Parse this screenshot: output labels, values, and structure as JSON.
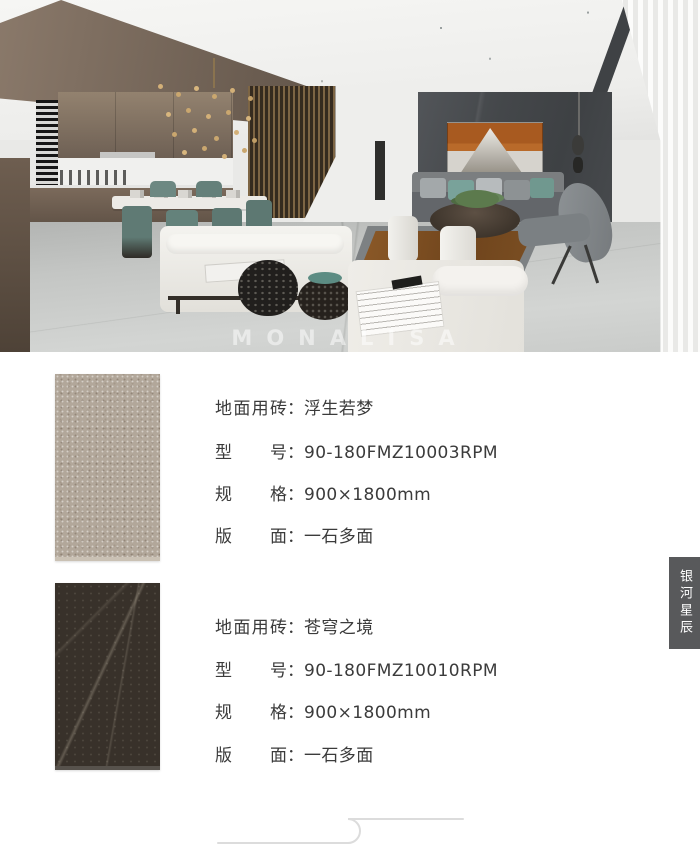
{
  "photo": {
    "watermark": "MONALISA"
  },
  "products": [
    {
      "swatch": "beige-stone-floor-tile",
      "rows": [
        {
          "label": "地面用砖",
          "colon": "：",
          "value": "浮生若梦"
        },
        {
          "label": "型号",
          "colon": "：",
          "value": "90-180FMZ10003RPM"
        },
        {
          "label": "规格",
          "colon": "：",
          "value": "900×1800mm"
        },
        {
          "label": "版面",
          "colon": "：",
          "value": "一石多面"
        }
      ]
    },
    {
      "swatch": "dark-marble-floor-tile",
      "rows": [
        {
          "label": "地面用砖",
          "colon": "：",
          "value": "苍穹之境"
        },
        {
          "label": "型号",
          "colon": "：",
          "value": "90-180FMZ10010RPM"
        },
        {
          "label": "规格",
          "colon": "：",
          "value": "900×1800mm"
        },
        {
          "label": "版面",
          "colon": "：",
          "value": "一石多面"
        }
      ]
    }
  ],
  "side_tab": {
    "label": "银河星辰"
  },
  "colors": {
    "side_tab_bg": "#58595b",
    "spec_text": "#3b3b3b",
    "tile_beige": "#b2a79a",
    "tile_dark": "#38312a",
    "divider_line": "#dcdcdc",
    "art_accent": "#a85a20"
  }
}
